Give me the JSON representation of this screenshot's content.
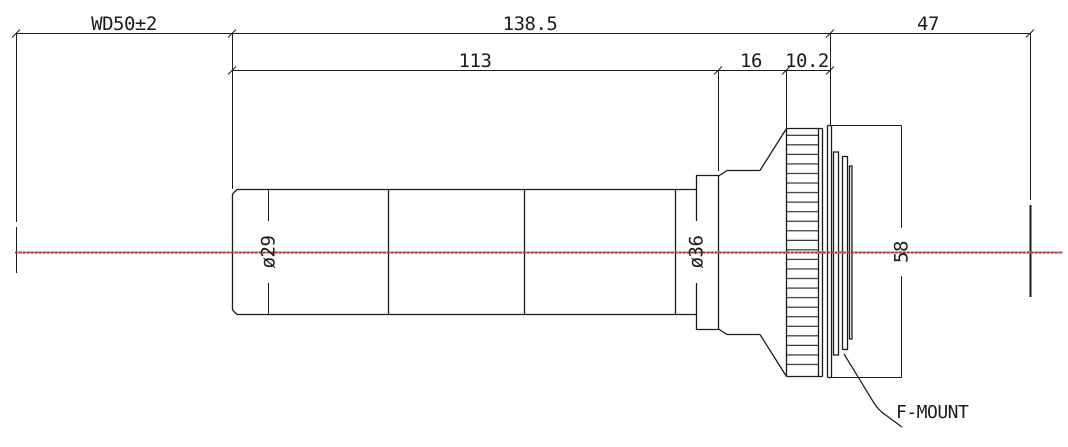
{
  "drawing": {
    "title": "lens-mechanical-drawing",
    "dimensions": {
      "working_distance": "WD50±2",
      "total_length": "138.5",
      "flange_focal_distance": "47",
      "barrel_length": "113",
      "ring_length": "16",
      "mount_offset": "10.2",
      "front_barrel_diameter": "ø29",
      "mid_ring_diameter": "ø36",
      "mount_flange_diameter": "58"
    },
    "annotations": {
      "mount_label": "F-MOUNT"
    },
    "colors": {
      "line": "#1b1b1b",
      "centerline_dark": "#a82626",
      "centerline_light": "#d98f8f",
      "background": "#ffffff"
    }
  }
}
